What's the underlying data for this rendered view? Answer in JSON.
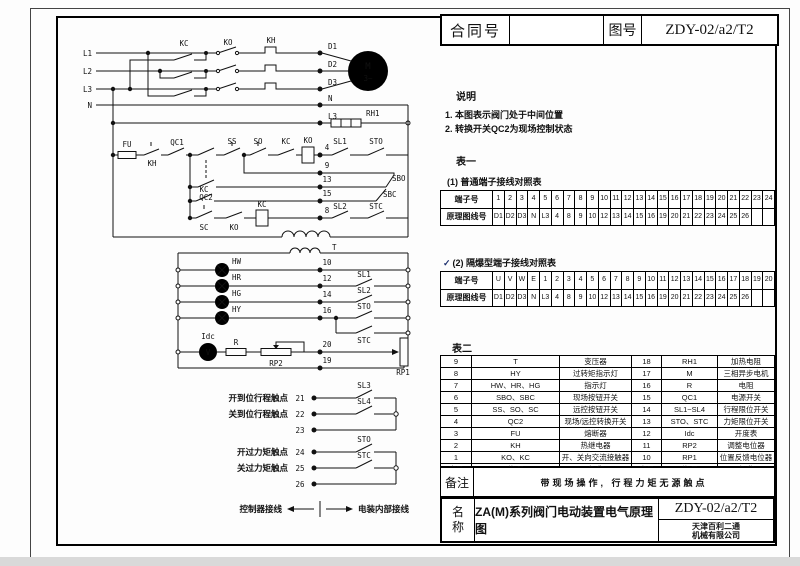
{
  "header": {
    "contract_label": "合同号",
    "contract_value": "",
    "drawing_label": "图号",
    "drawing_number": "ZDY-02/a2/T2"
  },
  "notes": {
    "title": "说明",
    "item1": "1. 本图表示阀门处于中间位置",
    "item2": "2. 转换开关QC2为现场控制状态"
  },
  "table1": {
    "title": "表一",
    "terminal_label": "端子号",
    "wire_label": "原理图线号",
    "sub1": {
      "caption": "(1)    普通端子接线对照表",
      "terminals": [
        "1",
        "2",
        "3",
        "4",
        "5",
        "6",
        "7",
        "8",
        "9",
        "10",
        "11",
        "12",
        "13",
        "14",
        "15",
        "16",
        "17",
        "18",
        "19",
        "20",
        "21",
        "22",
        "23",
        "24"
      ],
      "wires": [
        "D1",
        "D2",
        "D3",
        "N",
        "L3",
        "4",
        "8",
        "9",
        "10",
        "12",
        "13",
        "14",
        "15",
        "16",
        "19",
        "20",
        "21",
        "22",
        "23",
        "24",
        "25",
        "26",
        "",
        ""
      ]
    },
    "sub2": {
      "check": "✓",
      "caption": "(2)    隔爆型端子接线对照表",
      "terminals": [
        "U",
        "V",
        "W",
        "E",
        "1",
        "2",
        "3",
        "4",
        "5",
        "6",
        "7",
        "8",
        "9",
        "10",
        "11",
        "12",
        "13",
        "14",
        "15",
        "16",
        "17",
        "18",
        "19",
        "20"
      ],
      "wires": [
        "D1",
        "D2",
        "D3",
        "N",
        "L3",
        "4",
        "8",
        "9",
        "10",
        "12",
        "13",
        "14",
        "15",
        "16",
        "19",
        "20",
        "21",
        "22",
        "23",
        "24",
        "25",
        "26",
        "",
        ""
      ]
    }
  },
  "table2": {
    "title": "表二",
    "rows": [
      [
        "9",
        "T",
        "变压器",
        "18",
        "RH1",
        "加热电阻"
      ],
      [
        "8",
        "HY",
        "过转矩指示灯",
        "17",
        "M",
        "三相异步电机"
      ],
      [
        "7",
        "HW、HR、HG",
        "指示灯",
        "16",
        "R",
        "电阻"
      ],
      [
        "6",
        "SBO、SBC",
        "现场按钮开关",
        "15",
        "QC1",
        "电源开关"
      ],
      [
        "5",
        "SS、SO、SC",
        "远控按钮开关",
        "14",
        "SL1~SL4",
        "行程限位开关"
      ],
      [
        "4",
        "QC2",
        "现场/远控转换开关",
        "13",
        "STO、STC",
        "力矩限位开关"
      ],
      [
        "3",
        "FU",
        "熔断器",
        "12",
        "Idc",
        "开度表"
      ],
      [
        "2",
        "KH",
        "热继电器",
        "11",
        "RP2",
        "调整电位器"
      ],
      [
        "1",
        "KO、KC",
        "开、关向交流接触器",
        "10",
        "RP1",
        "位置反馈电位器"
      ]
    ],
    "footer": [
      "序号",
      "代 号",
      "名 称",
      "序号",
      "代 号",
      "名 称"
    ]
  },
  "remark": {
    "label": "备注",
    "text": "带现场操作, 行程力矩无源触点"
  },
  "titleblock": {
    "label": "名称",
    "name": "ZA(M)系列阀门电动装置电气原理图",
    "drawing_number": "ZDY-02/a2/T2",
    "company_line1": "天津百利二通",
    "company_line2": "机械有限公司"
  },
  "circuit": {
    "labels": {
      "L1": "L1",
      "L2": "L2",
      "L3": "L3",
      "N": "N",
      "KC": "KC",
      "KO": "KO",
      "KH": "KH",
      "D1": "D1",
      "D2": "D2",
      "D3": "D3",
      "M": "M",
      "M3": "3~",
      "RH1": "RH1",
      "FU": "FU",
      "QC1": "QC1",
      "QC2": "QC2",
      "SS": "SS",
      "SO": "SO",
      "SC": "SC",
      "t4": "4",
      "t8": "8",
      "t9": "9",
      "t13": "13",
      "t15": "15",
      "SL1": "SL1",
      "SL2": "SL2",
      "SL3": "SL3",
      "SL4": "SL4",
      "STO": "STO",
      "STC": "STC",
      "SBO": "SBO",
      "SBC": "SBC",
      "T": "T",
      "HW": "HW",
      "HR": "HR",
      "HG": "HG",
      "HY": "HY",
      "t10": "10",
      "t12": "12",
      "t14": "14",
      "t16": "16",
      "t19": "19",
      "t20": "20",
      "Idc": "Idc",
      "V": "V",
      "R": "R",
      "RP1": "RP1",
      "RP2": "RP2",
      "t21": "21",
      "t22": "22",
      "t23": "23",
      "t24": "24",
      "t25": "25",
      "t26": "26",
      "open_travel": "开到位行程触点",
      "close_travel": "关到位行程触点",
      "open_torque": "开过力矩触点",
      "close_torque": "关过力矩触点",
      "legend_left": "控制器接线",
      "legend_right": "电装内部接线"
    }
  }
}
